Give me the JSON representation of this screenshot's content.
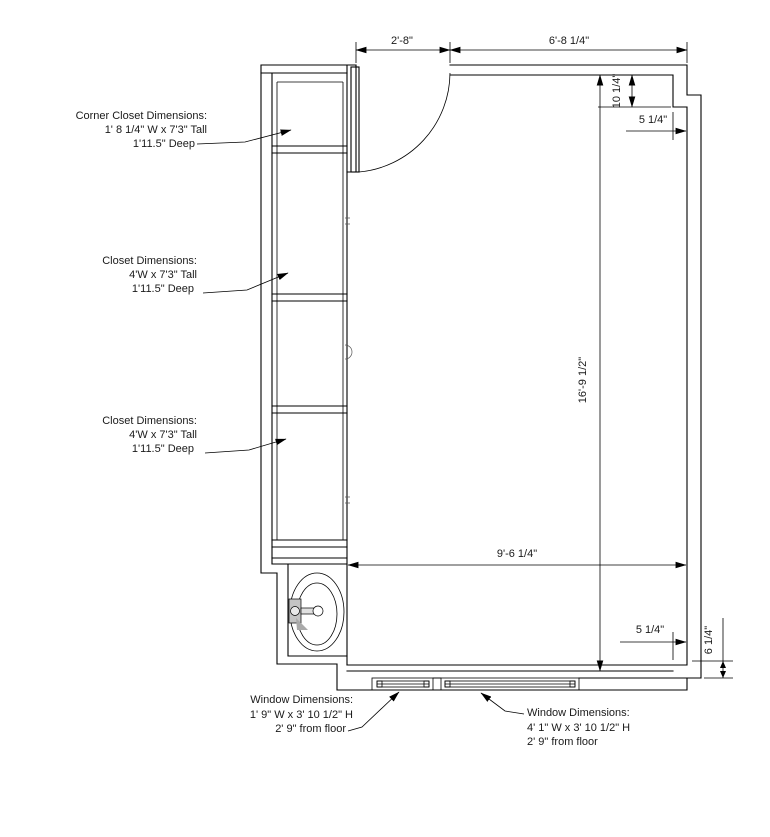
{
  "plan": {
    "background": "#ffffff",
    "line_color": "#000000",
    "text_color": "#1a1a1a",
    "faucet_fill": "#c4c4c4",
    "labels": {
      "corner_closet": {
        "line1": "Corner Closet Dimensions:",
        "line2": "1' 8 1/4\" W x 7'3\" Tall",
        "line3": "1'11.5\" Deep"
      },
      "closet_middle": {
        "line1": "Closet Dimensions:",
        "line2": "4'W x 7'3\" Tall",
        "line3": "1'11.5\" Deep"
      },
      "closet_lower": {
        "line1": "Closet Dimensions:",
        "line2": "4'W x 7'3\" Tall",
        "line3": "1'11.5\" Deep"
      },
      "window_small": {
        "line1": "Window Dimensions:",
        "line2": "1' 9\" W x 3' 10 1/2\" H",
        "line3": "2' 9\" from floor"
      },
      "window_large": {
        "line1": "Window Dimensions:",
        "line2": "4' 1\" W x 3' 10 1/2\" H",
        "line3": "2' 9\" from floor"
      }
    },
    "dims": {
      "door_opening": "2'-8\"",
      "top_wall": "6'-8 1/4\"",
      "right_jog_height": "10 1/4\"",
      "right_jog_width_top": "5 1/4\"",
      "room_height": "16'-9 1/2\"",
      "room_width": "9'-6 1/4\"",
      "right_jog_width_bottom": "5 1/4\"",
      "bottom_corner_step": "6 1/4\""
    }
  }
}
